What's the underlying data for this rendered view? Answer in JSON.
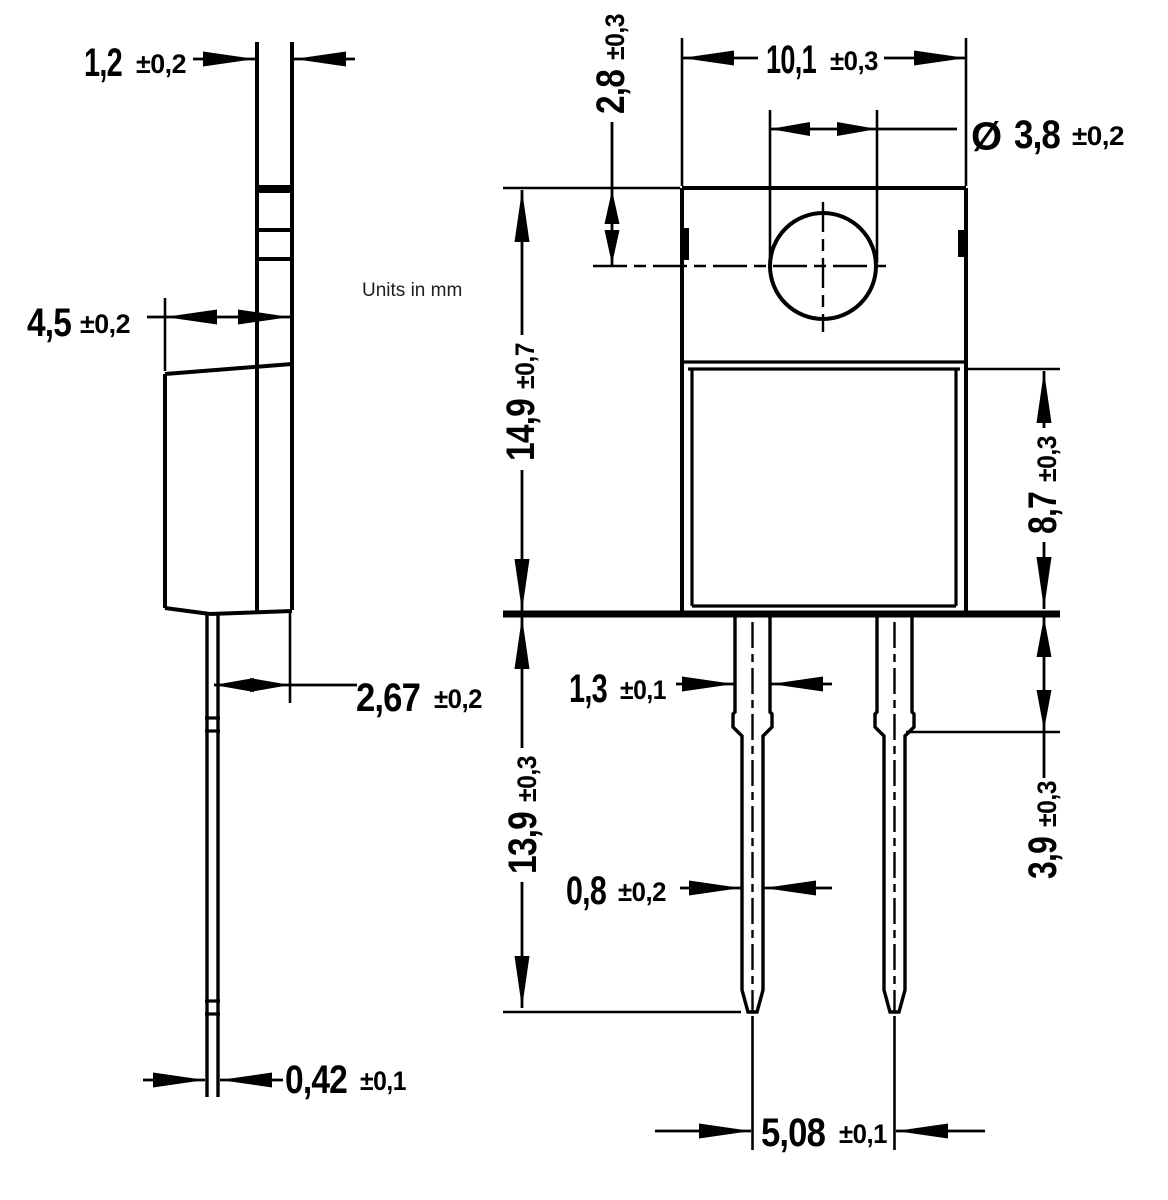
{
  "units_note": "Units in mm",
  "colors": {
    "line": "#000000",
    "background": "#ffffff"
  },
  "dims": {
    "tab_thickness": {
      "value": "1,2",
      "tol": "±0,2"
    },
    "body_depth": {
      "value": "4,5",
      "tol": "±0,2"
    },
    "lead_setback": {
      "value": "2,67",
      "tol": "±0,2"
    },
    "lead_thickness_side": {
      "value": "0,42",
      "tol": "±0,1"
    },
    "body_width": {
      "value": "10,1",
      "tol": "±0,3"
    },
    "hole_diameter": {
      "prefix": "Ø",
      "value": "3,8",
      "tol": "±0,2"
    },
    "hole_center_offset": {
      "value": "2,8",
      "tol": "±0,3"
    },
    "overall_height": {
      "value": "14,9",
      "tol": "±0,7"
    },
    "body_height": {
      "value": "8,7",
      "tol": "±0,3"
    },
    "lead_shoulder_length": {
      "value": "3,9",
      "tol": "±0,3"
    },
    "lead_width_wide": {
      "value": "1,3",
      "tol": "±0,1"
    },
    "lead_width_narrow": {
      "value": "0,8",
      "tol": "±0,2"
    },
    "lead_length": {
      "value": "13,9",
      "tol": "±0,3"
    },
    "lead_pitch": {
      "value": "5,08",
      "tol": "±0,1"
    }
  }
}
